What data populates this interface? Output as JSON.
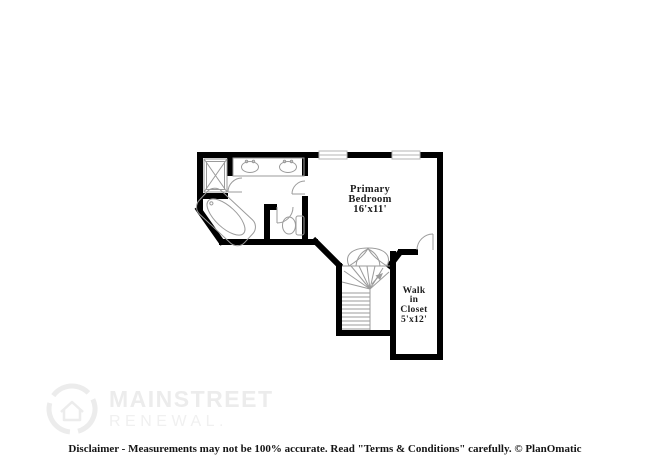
{
  "rooms": [
    {
      "id": "primary-bedroom",
      "lines": [
        "Primary",
        "Bedroom",
        "16'x11'"
      ]
    },
    {
      "id": "walk-in-closet",
      "lines": [
        "Walk",
        "in",
        "Closet",
        "5'x12'"
      ]
    }
  ],
  "watermark": {
    "brand": "MAINSTREET",
    "sub": "RENEWAL."
  },
  "footer": {
    "disclaimer": "Disclaimer - Measurements may not be 100% accurate. Read \"Terms & Conditions\" carefully. © PlanOmatic"
  },
  "colors": {
    "background": "#ffffff",
    "wall": "#000000",
    "fixture": "#9b9b9b",
    "fixture_light": "#b5b5b5",
    "label": "#1c1c1c",
    "watermark": "#ececec",
    "watermark_sub": "#f0f0f0",
    "disclaimer": "#151515"
  }
}
